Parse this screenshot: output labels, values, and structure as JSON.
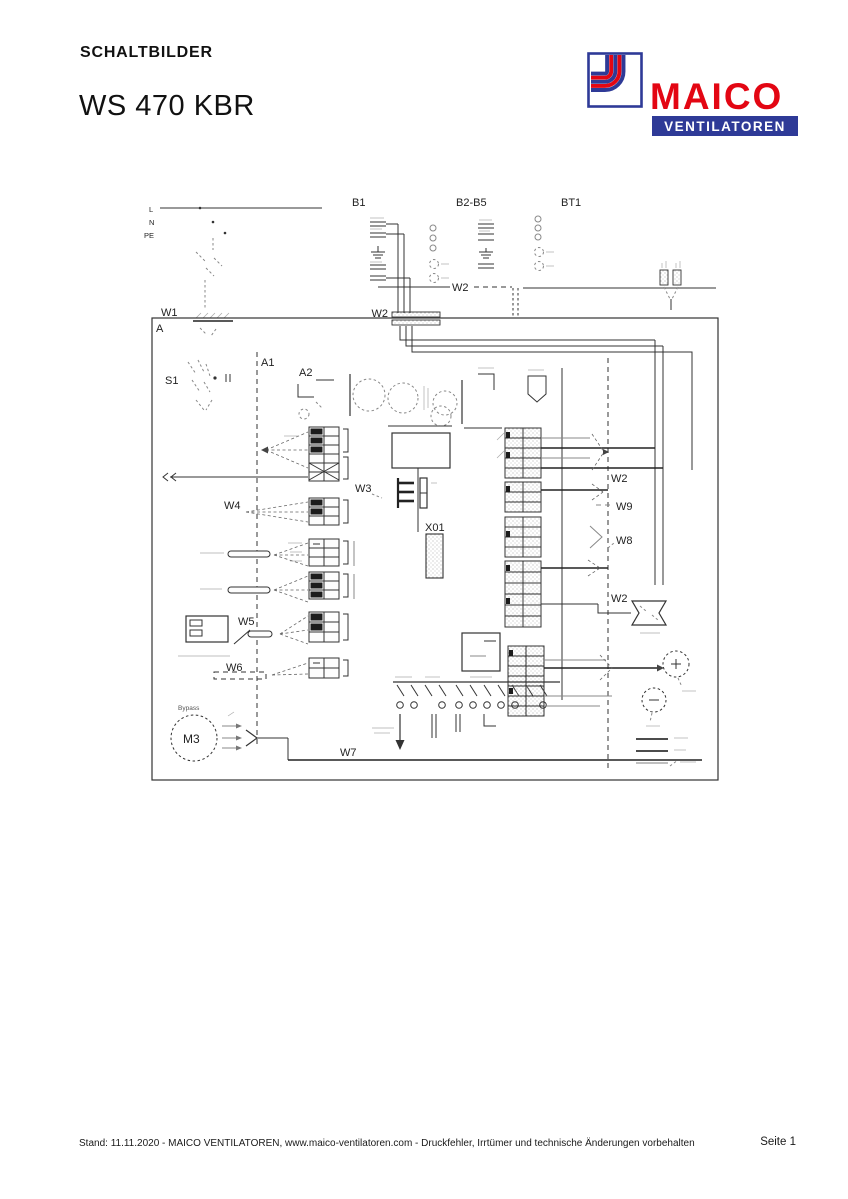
{
  "header": {
    "section_title": "SCHALTBILDER",
    "product_title": "WS 470 KBR"
  },
  "logo": {
    "brand": "MAICO",
    "subtitle": "VENTILATOREN",
    "brand_color": "#e30613",
    "bar_color": "#2e3a97",
    "border_color": "#2e3a97"
  },
  "diagram": {
    "ink_color": "#333333",
    "labels": {
      "l": "L",
      "n": "N",
      "pe": "PE",
      "a": "A",
      "a1": "A1",
      "a2": "A2",
      "s1": "S1",
      "b1": "B1",
      "b2_b5": "B2-B5",
      "bt1": "BT1",
      "w1": "W1",
      "w2_a": "W2",
      "w2_b": "W2",
      "w2_c": "W2",
      "w2_d": "W2",
      "w3": "W3",
      "w4": "W4",
      "w5": "W5",
      "w6": "W6",
      "w7": "W7",
      "w8": "W8",
      "w9": "W9",
      "x01": "X01",
      "m3": "M3",
      "m3_caption": "Bypass"
    }
  },
  "footer": {
    "info": "Stand: 11.11.2020 - MAICO VENTILATOREN, www.maico-ventilatoren.com - Druckfehler, Irrtümer und technische Änderungen vorbehalten",
    "page": "Seite 1"
  }
}
